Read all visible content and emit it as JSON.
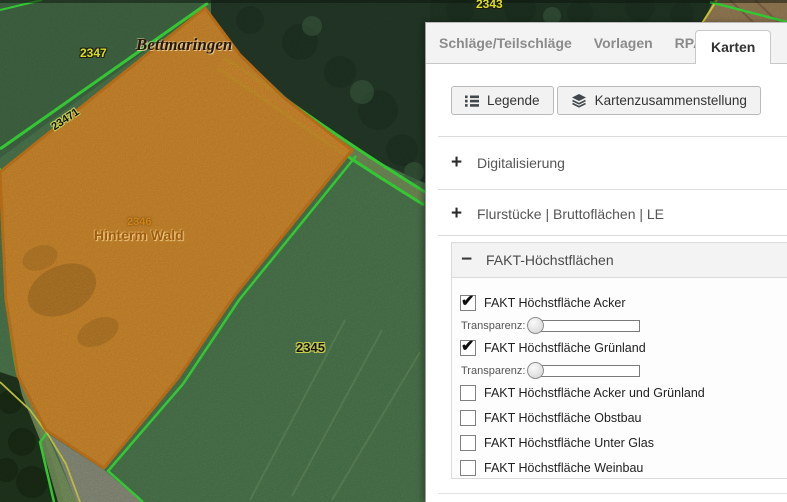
{
  "icons": {
    "expand": "+",
    "collapse": "−",
    "check": "✔"
  },
  "map": {
    "labels": {
      "parcel_2347": "2347",
      "parcel_2343": "2343",
      "parcel_23471": "23471",
      "parcel_2346": "2346",
      "parcel_2345": "2345",
      "place_name": "Bettmaringen",
      "field_name": "Hinterm Wald"
    },
    "colors": {
      "highlight_fill": "#e18f2d",
      "highlight_border": "#cf7c1c",
      "parcel_line": "#3ce63c"
    }
  },
  "panel": {
    "tabs": [
      {
        "label": "Schläge/Teilschläge",
        "active": false
      },
      {
        "label": "Vorlagen",
        "active": false
      },
      {
        "label": "RPA",
        "active": false
      },
      {
        "label": "Karten",
        "active": true
      }
    ],
    "toolbar": {
      "legend_label": "Legende",
      "map_composition_label": "Kartenzusammenstellung"
    },
    "sections": [
      {
        "label": "Digitalisierung",
        "state": "collapsed"
      },
      {
        "label": "Flurstücke | Bruttoflächen | LE",
        "state": "collapsed"
      },
      {
        "label": "FAKT-Höchstflächen",
        "state": "expanded"
      }
    ],
    "fakt": {
      "transparency_label": "Transparenz:",
      "items": [
        {
          "label": "FAKT Höchstfläche Acker",
          "checked": true,
          "has_slider": true,
          "slider_value": 0
        },
        {
          "label": "FAKT Höchstfläche Grünland",
          "checked": true,
          "has_slider": true,
          "slider_value": 0
        },
        {
          "label": "FAKT Höchstfläche Acker und Grünland",
          "checked": false
        },
        {
          "label": "FAKT Höchstfläche Obstbau",
          "checked": false
        },
        {
          "label": "FAKT Höchstfläche Unter Glas",
          "checked": false
        },
        {
          "label": "FAKT Höchstfläche Weinbau",
          "checked": false
        }
      ]
    }
  }
}
